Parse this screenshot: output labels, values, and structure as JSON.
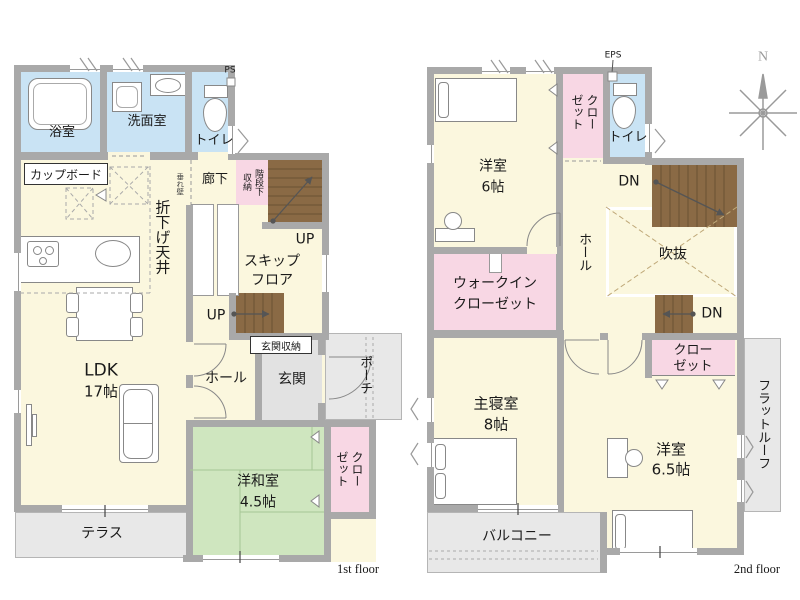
{
  "colors": {
    "floor": "#fbf7de",
    "water": "#c9e3f4",
    "closet": "#f8d7e4",
    "tatami": "#cfe6bf",
    "gray-area": "#e8e8e8",
    "entrance-gray": "#e2e2e2",
    "wall": "#a9a9a9",
    "stairs": "#8a6a45",
    "stair-line": "#6a5133",
    "outline": "#888888",
    "tatami-line": "#a5c694",
    "void-dash": "#bfa878",
    "text": "#1a1a1a",
    "compass": "#9a9a9a"
  },
  "floor1": {
    "floor_label": "1st floor",
    "bath": "浴室",
    "washroom": "洗面室",
    "toilet": "トイレ",
    "ps": "PS",
    "cupboard": "カップボード",
    "corridor": "廊下",
    "hanging_wall": "垂れ壁",
    "under_stairs_storage": "階段下収納",
    "dropped_ceiling": "折下げ天井",
    "up_upper": "UP",
    "up_lower": "UP",
    "skip_floor_line1": "スキップ",
    "skip_floor_line2": "フロア",
    "ldk_name": "LDK",
    "ldk_size": "17帖",
    "hall": "ホール",
    "entrance_storage": "玄関収納",
    "entrance": "玄関",
    "porch": "ポーチ",
    "jp_room_name": "洋和室",
    "jp_room_size": "4.5帖",
    "closet": "クローゼット",
    "terrace": "テラス"
  },
  "floor2": {
    "floor_label": "2nd floor",
    "eps": "EPS",
    "room6_name": "洋室",
    "room6_size": "6帖",
    "closet_top": "クローゼット",
    "toilet": "トイレ",
    "dn_upper": "DN",
    "dn_lower": "DN",
    "hall": "ホール",
    "void": "吹抜",
    "wic_line1": "ウォークイン",
    "wic_line2": "クローゼット",
    "master_name": "主寝室",
    "master_size": "8帖",
    "room65_name": "洋室",
    "room65_size": "6.5帖",
    "closet_bottom_line1": "クロー",
    "closet_bottom_line2": "ゼット",
    "flat_roof": "フラットルーフ",
    "balcony": "バルコニー"
  },
  "compass": {
    "north": "N"
  }
}
